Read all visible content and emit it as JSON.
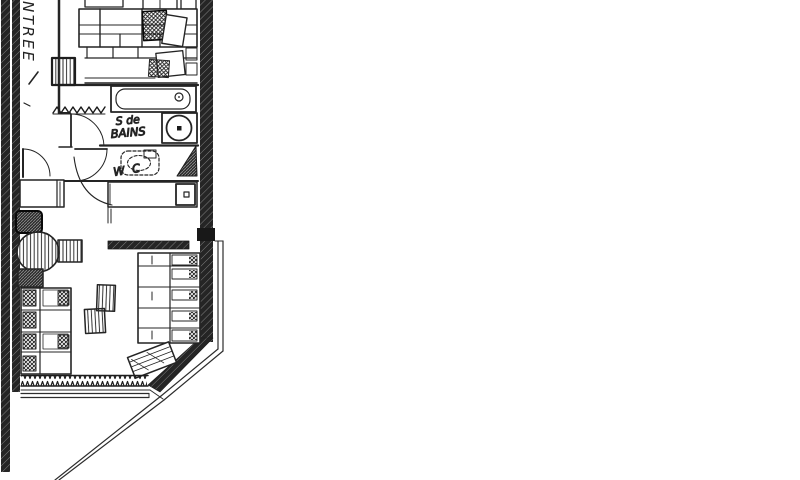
{
  "page": {
    "background_color": "#ffffff"
  },
  "floor_plan": {
    "type": "hand-drawn apartment floor plan scan",
    "ink_color": "#1c1c1c",
    "paper_color": "#ffffff",
    "labels": {
      "entrance": "ENTREE",
      "bathroom_line1": "S de",
      "bathroom_line2": "BAINS",
      "toilet": "W C"
    }
  }
}
